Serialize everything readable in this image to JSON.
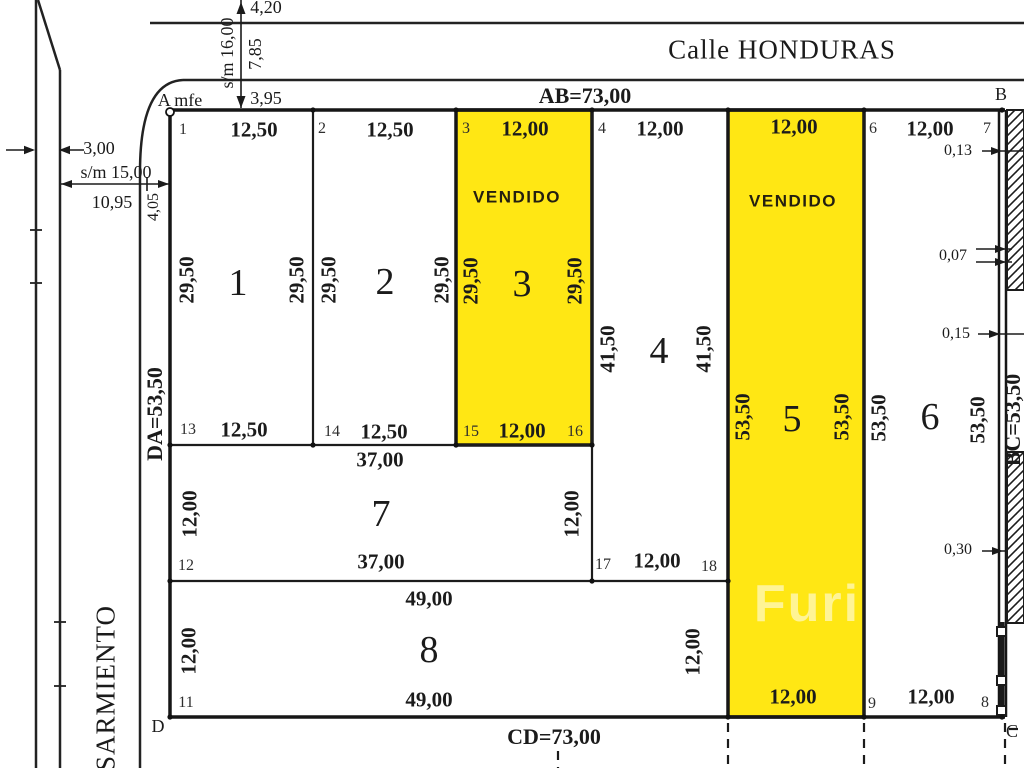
{
  "document_type": "land-subdivision-survey-plan",
  "streets": {
    "top": "Calle HONDURAS",
    "left": "SARMIENTO"
  },
  "boundaries": {
    "ab": "AB=73,00",
    "cd": "CD=73,00",
    "da": "DA=53,50",
    "bc": "BC=53,50"
  },
  "corners": {
    "a": "A mfe",
    "b": "B",
    "c": "C",
    "d": "D"
  },
  "sold_text": "VENDIDO",
  "watermark": "Furi",
  "colors": {
    "sold_fill": "#FFE714",
    "line": "#1b1b1b",
    "background": "#ffffff",
    "vendido_text": "#241f10"
  },
  "lots": [
    {
      "number": "1",
      "frontage": "12,50",
      "depth": "29,50",
      "sold": false
    },
    {
      "number": "2",
      "frontage": "12,50",
      "depth": "29,50",
      "sold": false
    },
    {
      "number": "3",
      "frontage": "12,00",
      "depth": "29,50",
      "sold": true
    },
    {
      "number": "4",
      "frontage": "12,00",
      "depth": "41,50",
      "sold": false
    },
    {
      "number": "5",
      "frontage": "12,00",
      "depth": "53,50",
      "sold": true
    },
    {
      "number": "6",
      "frontage": "12,00",
      "depth": "53,50",
      "sold": false
    },
    {
      "number": "7",
      "frontage": "37,00",
      "depth": "12,00",
      "sold": false
    },
    {
      "number": "8",
      "frontage": "49,00",
      "depth": "12,00",
      "sold": false
    }
  ],
  "labels": [
    {
      "name": "dim-4-20",
      "text": "4,20",
      "x": 266,
      "y": 7,
      "cls": "plain"
    },
    {
      "name": "dim-sm-16-00",
      "text": "s/m 16,00",
      "x": 227,
      "y": 53,
      "cls": "plain",
      "rot": -90
    },
    {
      "name": "dim-7-85",
      "text": "7,85",
      "x": 255,
      "y": 54,
      "cls": "plain",
      "rot": -90
    },
    {
      "name": "dim-3-95",
      "text": "3,95",
      "x": 266,
      "y": 98,
      "cls": "plain"
    },
    {
      "name": "dim-3-00",
      "text": "3,00",
      "x": 99,
      "y": 148,
      "cls": "plain"
    },
    {
      "name": "dim-sm-15-00",
      "text": "s/m 15,00",
      "x": 116,
      "y": 172,
      "cls": "plain"
    },
    {
      "name": "dim-10-95",
      "text": "10,95",
      "x": 112,
      "y": 202,
      "cls": "plain"
    },
    {
      "name": "dim-4-05",
      "text": "4,05",
      "x": 154,
      "y": 207,
      "cls": "plainsm",
      "rot": -90
    },
    {
      "name": "street-name-honduras",
      "text": "Calle HONDURAS",
      "x": 782,
      "y": 50,
      "cls": "street"
    },
    {
      "name": "street-name-sarmiento",
      "text": "SARMIENTO",
      "x": 106,
      "y": 688,
      "cls": "street",
      "rot": -90
    },
    {
      "name": "boundary-ab-label",
      "text": "AB=73,00",
      "x": 585,
      "y": 96,
      "cls": "big"
    },
    {
      "name": "boundary-cd-label",
      "text": "CD=73,00",
      "x": 554,
      "y": 737,
      "cls": "big"
    },
    {
      "name": "boundary-da-label",
      "text": "DA=53,50",
      "x": 155,
      "y": 414,
      "cls": "big",
      "rot": -90
    },
    {
      "name": "boundary-bc-label",
      "text": "BC=53,50",
      "x": 1013,
      "y": 420,
      "cls": "big",
      "rot": -90
    },
    {
      "name": "corner-a-label",
      "text": "A mfe",
      "x": 180,
      "y": 100,
      "cls": "corner"
    },
    {
      "name": "corner-b-label",
      "text": "B",
      "x": 1001,
      "y": 94,
      "cls": "corner"
    },
    {
      "name": "corner-c-label",
      "text": "C",
      "x": 1012,
      "y": 731,
      "cls": "corner"
    },
    {
      "name": "corner-d-label",
      "text": "D",
      "x": 158,
      "y": 726,
      "cls": "corner"
    },
    {
      "name": "vertex-1",
      "text": "1",
      "x": 183,
      "y": 130,
      "cls": "vtx"
    },
    {
      "name": "lot1-front",
      "text": "12,50",
      "x": 254,
      "y": 130,
      "cls": "dim"
    },
    {
      "name": "vertex-2",
      "text": "2",
      "x": 322,
      "y": 129,
      "cls": "vtx"
    },
    {
      "name": "lot2-front",
      "text": "12,50",
      "x": 390,
      "y": 130,
      "cls": "dim"
    },
    {
      "name": "vertex-3",
      "text": "3",
      "x": 466,
      "y": 129,
      "cls": "vtx"
    },
    {
      "name": "lot3-front",
      "text": "12,00",
      "x": 525,
      "y": 129,
      "cls": "dim"
    },
    {
      "name": "vertex-4",
      "text": "4",
      "x": 602,
      "y": 129,
      "cls": "vtx"
    },
    {
      "name": "lot4-front",
      "text": "12,00",
      "x": 660,
      "y": 129,
      "cls": "dim"
    },
    {
      "name": "lot5-front",
      "text": "12,00",
      "x": 794,
      "y": 127,
      "cls": "dim"
    },
    {
      "name": "vertex-6",
      "text": "6",
      "x": 873,
      "y": 129,
      "cls": "vtx"
    },
    {
      "name": "lot6-front",
      "text": "12,00",
      "x": 930,
      "y": 129,
      "cls": "dim"
    },
    {
      "name": "vertex-7",
      "text": "7",
      "x": 987,
      "y": 129,
      "cls": "vtx"
    },
    {
      "name": "lot3-sold-label",
      "text": "VENDIDO",
      "x": 517,
      "y": 197,
      "cls": "vendido"
    },
    {
      "name": "lot5-sold-label",
      "text": "VENDIDO",
      "x": 793,
      "y": 201,
      "cls": "vendido"
    },
    {
      "name": "lot1-depth-left",
      "text": "29,50",
      "x": 187,
      "y": 280,
      "cls": "dim",
      "rot": -90
    },
    {
      "name": "lot1-number",
      "text": "1",
      "x": 238,
      "y": 283,
      "cls": "lotnum"
    },
    {
      "name": "lot1-depth-right",
      "text": "29,50",
      "x": 297,
      "y": 280,
      "cls": "dim",
      "rot": -90
    },
    {
      "name": "lot2-depth-left",
      "text": "29,50",
      "x": 329,
      "y": 280,
      "cls": "dim",
      "rot": -90
    },
    {
      "name": "lot2-number",
      "text": "2",
      "x": 385,
      "y": 282,
      "cls": "lotnum"
    },
    {
      "name": "lot2-depth-right",
      "text": "29,50",
      "x": 442,
      "y": 280,
      "cls": "dim",
      "rot": -90
    },
    {
      "name": "lot3-depth-left",
      "text": "29,50",
      "x": 471,
      "y": 281,
      "cls": "dim",
      "rot": -90
    },
    {
      "name": "lot3-number",
      "text": "3",
      "x": 522,
      "y": 284,
      "cls": "lotnum"
    },
    {
      "name": "lot3-depth-right",
      "text": "29,50",
      "x": 575,
      "y": 281,
      "cls": "dim",
      "rot": -90
    },
    {
      "name": "lot4-depth-left",
      "text": "41,50",
      "x": 608,
      "y": 349,
      "cls": "dim",
      "rot": -90
    },
    {
      "name": "lot4-number",
      "text": "4",
      "x": 659,
      "y": 351,
      "cls": "lotnum"
    },
    {
      "name": "lot4-depth-right",
      "text": "41,50",
      "x": 704,
      "y": 349,
      "cls": "dim",
      "rot": -90
    },
    {
      "name": "lot5-depth-left",
      "text": "53,50",
      "x": 743,
      "y": 417,
      "cls": "dim",
      "rot": -90
    },
    {
      "name": "lot5-number",
      "text": "5",
      "x": 792,
      "y": 419,
      "cls": "lotnum"
    },
    {
      "name": "lot5-depth-right",
      "text": "53,50",
      "x": 842,
      "y": 417,
      "cls": "dim",
      "rot": -90
    },
    {
      "name": "lot6-depth-left",
      "text": "53,50",
      "x": 879,
      "y": 418,
      "cls": "dim",
      "rot": -90
    },
    {
      "name": "lot6-number",
      "text": "6",
      "x": 930,
      "y": 417,
      "cls": "lotnum"
    },
    {
      "name": "lot6-depth-right",
      "text": "53,50",
      "x": 978,
      "y": 420,
      "cls": "dim",
      "rot": -90
    },
    {
      "name": "vertex-13",
      "text": "13",
      "x": 188,
      "y": 430,
      "cls": "vtx"
    },
    {
      "name": "lot1-back",
      "text": "12,50",
      "x": 244,
      "y": 430,
      "cls": "dim"
    },
    {
      "name": "vertex-14",
      "text": "14",
      "x": 332,
      "y": 432,
      "cls": "vtx"
    },
    {
      "name": "lot2-back",
      "text": "12,50",
      "x": 384,
      "y": 432,
      "cls": "dim"
    },
    {
      "name": "vertex-15",
      "text": "15",
      "x": 471,
      "y": 432,
      "cls": "vtx"
    },
    {
      "name": "lot3-back",
      "text": "12,00",
      "x": 522,
      "y": 431,
      "cls": "dim"
    },
    {
      "name": "vertex-16",
      "text": "16",
      "x": 575,
      "y": 432,
      "cls": "vtx"
    },
    {
      "name": "lot7-width-top",
      "text": "37,00",
      "x": 380,
      "y": 460,
      "cls": "dim"
    },
    {
      "name": "lot7-depth-left",
      "text": "12,00",
      "x": 190,
      "y": 514,
      "cls": "dim",
      "rot": -90
    },
    {
      "name": "lot7-number",
      "text": "7",
      "x": 381,
      "y": 514,
      "cls": "lotnum"
    },
    {
      "name": "lot7-depth-right",
      "text": "12,00",
      "x": 572,
      "y": 514,
      "cls": "dim",
      "rot": -90
    },
    {
      "name": "lot7-width-bottom",
      "text": "37,00",
      "x": 381,
      "y": 562,
      "cls": "dim"
    },
    {
      "name": "vertex-12",
      "text": "12",
      "x": 186,
      "y": 566,
      "cls": "vtx"
    },
    {
      "name": "vertex-17",
      "text": "17",
      "x": 603,
      "y": 565,
      "cls": "vtx"
    },
    {
      "name": "lot4-back",
      "text": "12,00",
      "x": 657,
      "y": 561,
      "cls": "dim"
    },
    {
      "name": "vertex-18",
      "text": "18",
      "x": 709,
      "y": 567,
      "cls": "vtx"
    },
    {
      "name": "lot8-width-top",
      "text": "49,00",
      "x": 429,
      "y": 599,
      "cls": "dim"
    },
    {
      "name": "lot8-depth-left",
      "text": "12,00",
      "x": 189,
      "y": 651,
      "cls": "dim",
      "rot": -90
    },
    {
      "name": "lot8-number",
      "text": "8",
      "x": 429,
      "y": 650,
      "cls": "lotnum"
    },
    {
      "name": "lot8-depth-right",
      "text": "12,00",
      "x": 693,
      "y": 652,
      "cls": "dim",
      "rot": -90
    },
    {
      "name": "lot8-width-bottom",
      "text": "49,00",
      "x": 429,
      "y": 700,
      "cls": "dim"
    },
    {
      "name": "vertex-11",
      "text": "11",
      "x": 186,
      "y": 703,
      "cls": "vtx"
    },
    {
      "name": "lot5-back",
      "text": "12,00",
      "x": 793,
      "y": 697,
      "cls": "dim"
    },
    {
      "name": "vertex-9",
      "text": "9",
      "x": 872,
      "y": 704,
      "cls": "vtx"
    },
    {
      "name": "lot6-back",
      "text": "12,00",
      "x": 931,
      "y": 697,
      "cls": "dim"
    },
    {
      "name": "vertex-8",
      "text": "8",
      "x": 985,
      "y": 703,
      "cls": "vtx"
    },
    {
      "name": "offset-0-13",
      "text": "0,13",
      "x": 958,
      "y": 151,
      "cls": "offset"
    },
    {
      "name": "offset-0-07",
      "text": "0,07",
      "x": 953,
      "y": 256,
      "cls": "offset"
    },
    {
      "name": "offset-0-15",
      "text": "0,15",
      "x": 956,
      "y": 334,
      "cls": "offset"
    },
    {
      "name": "offset-0-30",
      "text": "0,30",
      "x": 958,
      "y": 550,
      "cls": "offset"
    },
    {
      "name": "watermark",
      "text": "Furi",
      "x": 807,
      "y": 604,
      "cls": "wm"
    }
  ]
}
